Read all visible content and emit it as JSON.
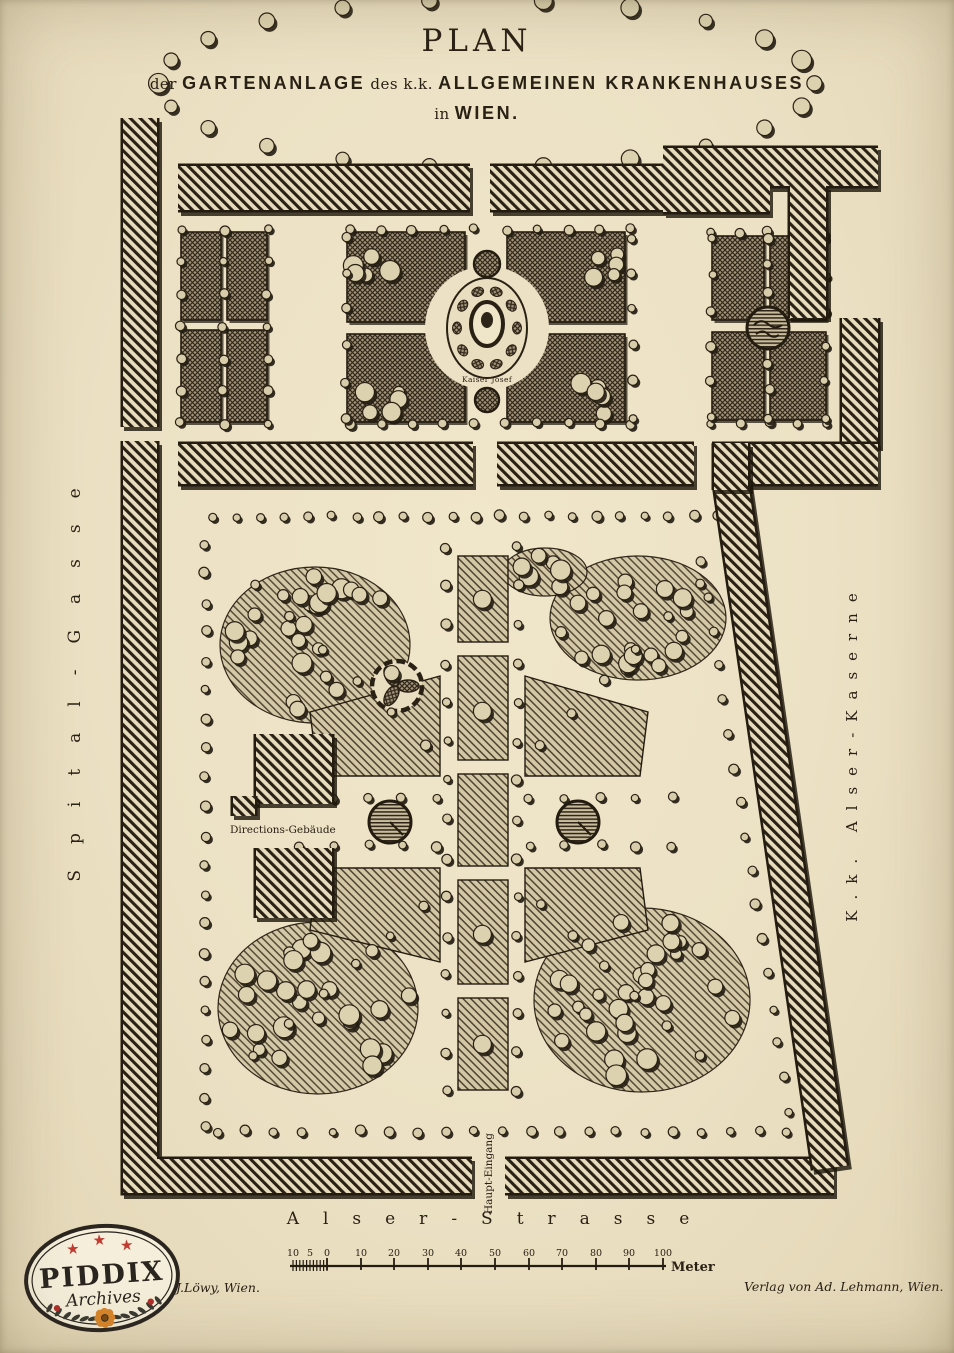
{
  "title": {
    "line1": "PLAN",
    "line2_small1": "der",
    "line2_big1": "GARTENANLAGE",
    "line2_small2": "des k.k.",
    "line2_big2": "ALLGEMEINEN KRANKENHAUSES",
    "line3_small": "in",
    "line3_big": "WIEN."
  },
  "streets": {
    "left": "Spital-Gasse",
    "right": "K.k. Alser-Kaserne",
    "bottom": "Alser-Strasse",
    "entrance": "Haupt-Eingang"
  },
  "map_labels": {
    "monument": "Kaiser Josef",
    "building": "Directions-Gebäude"
  },
  "scale_bar": {
    "labels": [
      "10",
      "5",
      "0",
      "10",
      "20",
      "30",
      "40",
      "50",
      "60",
      "70",
      "80",
      "90",
      "100"
    ],
    "unit": "Meter"
  },
  "credits": {
    "left": "J.Löwy, Wien.",
    "right": "Verlag von Ad. Lehmann, Wien."
  },
  "watermark": {
    "name": "PIDDIX",
    "subtitle": "Archives"
  },
  "icons": {
    "star": "★"
  },
  "colors": {
    "paper": "#ece1c4",
    "ink": "#2a2115",
    "red": "#c23b31",
    "orange": "#d8862b"
  }
}
